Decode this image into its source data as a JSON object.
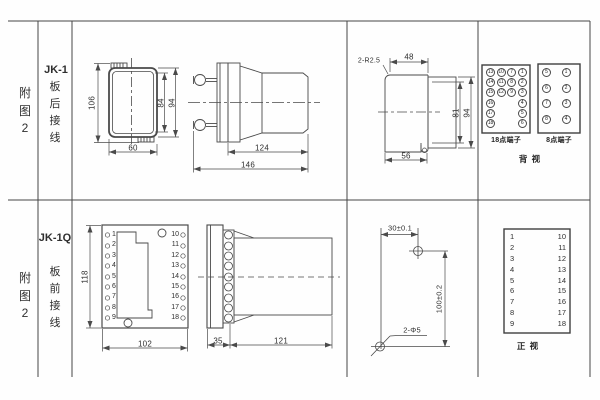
{
  "sheet": {
    "colors": {
      "line": "#4a4a4a",
      "text": "#2f2f2f",
      "background": "#fefefe"
    },
    "rows": [
      {
        "fig_chars": [
          "附",
          "图",
          "2"
        ],
        "model": "JK-1",
        "wiring_chars": [
          "板",
          "后",
          "接",
          "线"
        ]
      },
      {
        "fig_chars": [
          "附",
          "图",
          "2"
        ],
        "model": "JK-1Q",
        "wiring_chars": [
          "板",
          "前",
          "接",
          "线"
        ]
      }
    ]
  },
  "jk1": {
    "front": {
      "dim_overall_h": "106",
      "dim_window_h": "84",
      "dim_flange_h": "94",
      "dim_w": "60"
    },
    "side": {
      "dim_body": "124",
      "dim_overall": "146"
    },
    "cutout": {
      "radius_note": "2-R2.5",
      "dim_top": "48",
      "dim_inner_h": "81",
      "dim_outer_h": "94",
      "dim_w": "56"
    },
    "terminal18": {
      "caption": "18点端子",
      "cells": [
        "13",
        "10",
        "7",
        "1",
        "14",
        "11",
        "8",
        "2",
        "15",
        "12",
        "9",
        "3",
        "16",
        "",
        "",
        "4",
        "17",
        "",
        "",
        "5",
        "18",
        "",
        "",
        "6"
      ]
    },
    "terminal8": {
      "caption": "8点端子",
      "cells": [
        "5",
        "1",
        "6",
        "2",
        "7",
        "3",
        "8",
        "4"
      ]
    },
    "view_label": "背 视"
  },
  "jk1q": {
    "front": {
      "dim_h": "118",
      "dim_w": "102",
      "left_terminals": [
        "1",
        "2",
        "3",
        "4",
        "5",
        "6",
        "7",
        "8",
        "9"
      ],
      "right_terminals": [
        "10",
        "11",
        "12",
        "13",
        "14",
        "15",
        "16",
        "17",
        "18"
      ]
    },
    "side": {
      "dim_flange": "35",
      "dim_body": "121"
    },
    "drill": {
      "dim_x": "30±0.1",
      "dim_y": "100±0.2",
      "holes": "2-Φ5"
    },
    "table": {
      "left": [
        "1",
        "2",
        "3",
        "4",
        "5",
        "6",
        "7",
        "8",
        "9"
      ],
      "right": [
        "10",
        "11",
        "12",
        "13",
        "14",
        "15",
        "16",
        "17",
        "18"
      ],
      "view_label": "正 视"
    }
  }
}
